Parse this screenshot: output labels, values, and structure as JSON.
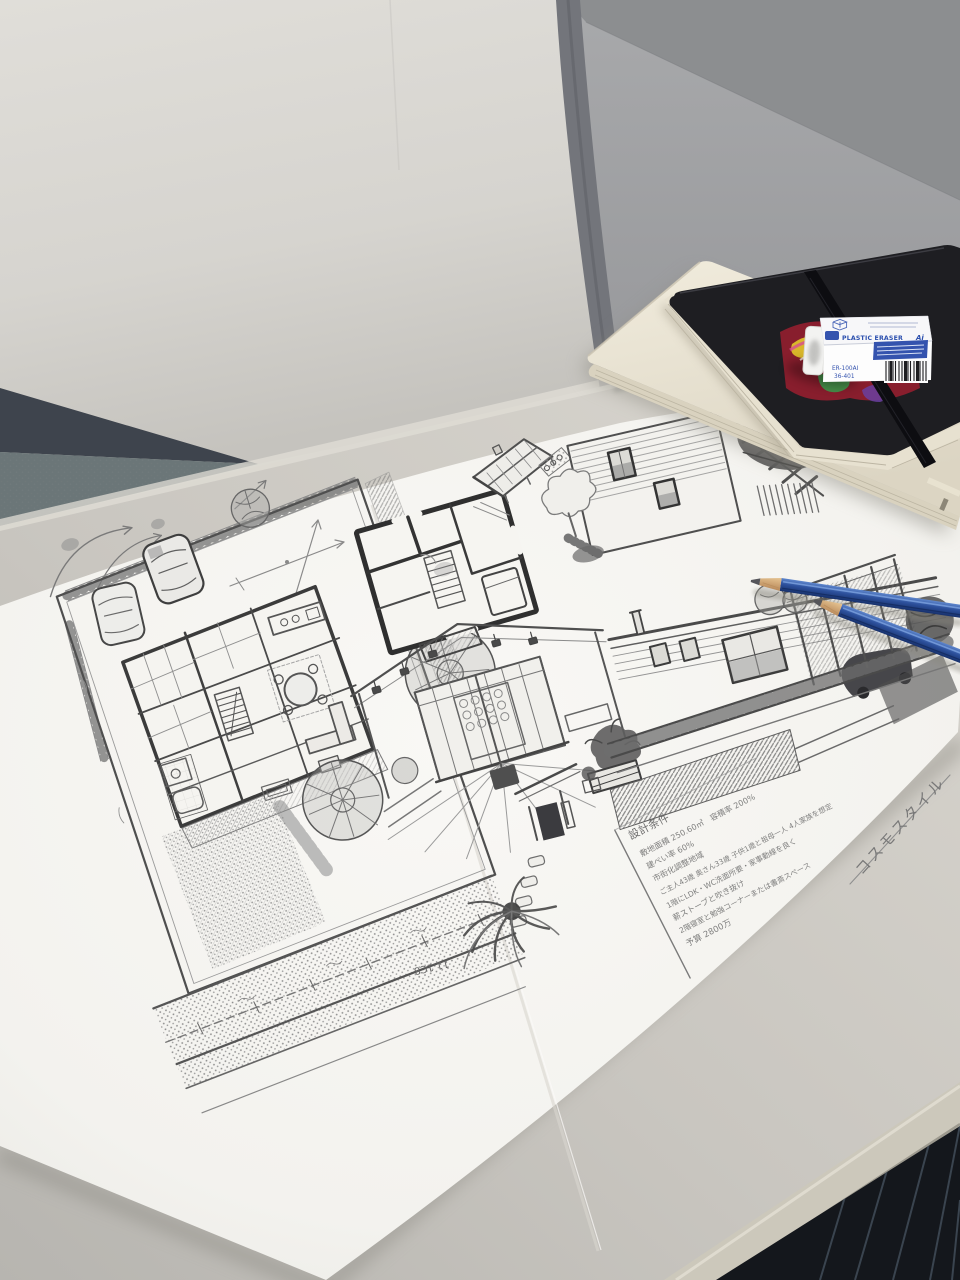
{
  "scene": {
    "description": "Architect's pencil sketch sheet (site plan, floor plans, interior and exterior perspective drawings) lying on an office cubicle desk with a black elastic-band notebook, a cream sketchbook, a plastic eraser and two blue pencils."
  },
  "colors": {
    "wall": "#dbd9d4",
    "baseboard": "#3e444d",
    "carpet": "#6b7678",
    "partition": "#a3a4a6",
    "partition_band": "#8c8e90",
    "partition_frame": "#73757b",
    "desk": "#cfccc5",
    "desk_edge": "#ccc8bb",
    "dark_floor": "#14171c",
    "floor_stripe": "#414d59",
    "paper": "#f6f5f1",
    "graphite": "#5e5e5e",
    "notebook": "#1e1e22",
    "elastic": "#0d0d11",
    "pages": "#e7e1d0",
    "sketchbook": "#ece7d8",
    "eraser_blue": "#3453ae",
    "pencil_blue": "#2d519d",
    "pencil_wood": "#d8b07e"
  },
  "paper": {
    "side_label": "コスモスタイル",
    "road_label": "11.1C8"
  },
  "design_conditions": {
    "title": "設計条件",
    "lines": [
      "敷地面積 250.60㎡　容積率 200%",
      "建ぺい率 60%",
      "市街化調整地域",
      "ご主人43歳 奥さん33歳 子供1歳と祖母一人 4人家族を想定",
      "1階にLDK・WC洗面所要・家事動線を良く",
      "薪ストーブと吹き抜け",
      "2階寝室と勉強コーナーまたは書斎スペース",
      "予算 2800万"
    ]
  },
  "eraser": {
    "top_label": "PLASTIC ERASER",
    "top_suffix": "Ai",
    "model": "ER-100AI",
    "code": "36-401"
  }
}
